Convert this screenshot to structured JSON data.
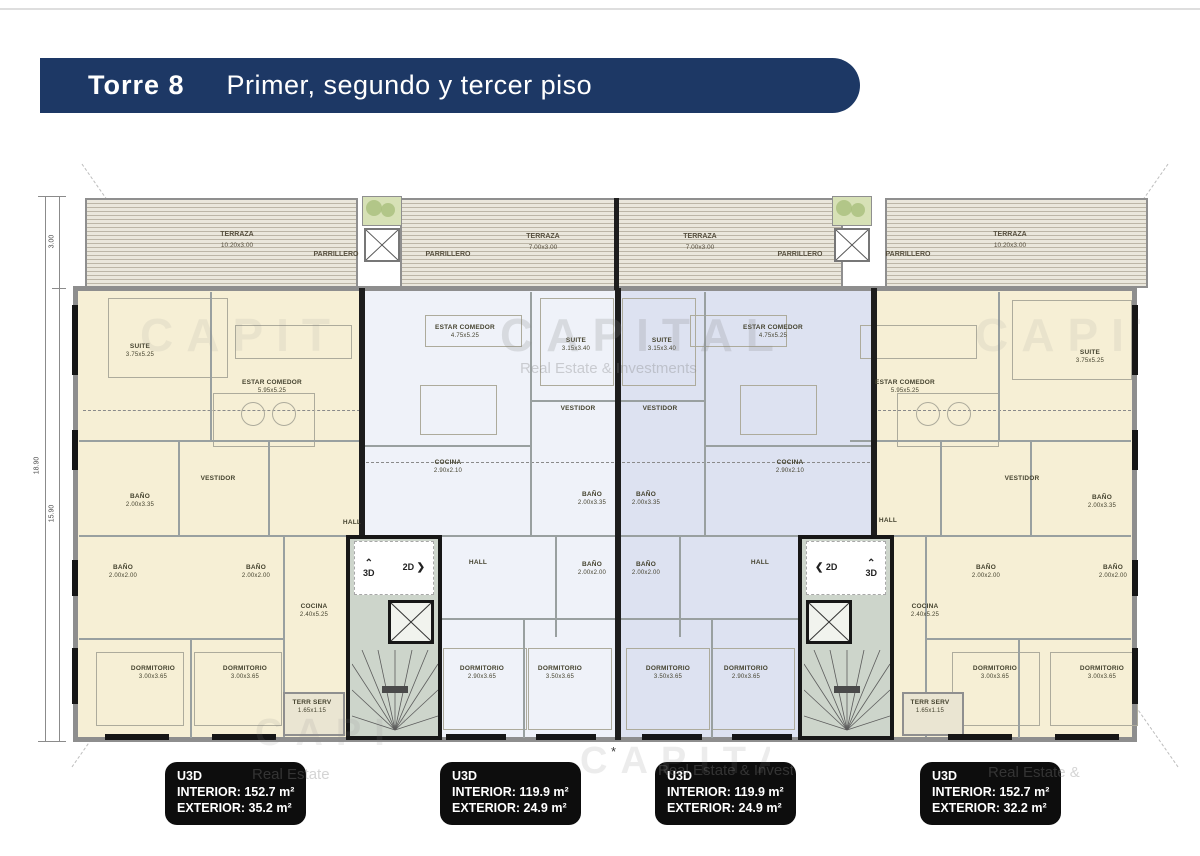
{
  "header": {
    "tower_label": "Torre  8",
    "floors_label": "Primer, segundo y tercer piso"
  },
  "watermark": {
    "brand": "CAPITAL",
    "tagline": "Real Estate & Investments"
  },
  "dims": {
    "total_height": "18.90",
    "inner_height": "15.90",
    "terrace_depth": "3.00"
  },
  "terrace": {
    "t1": {
      "name": "TERRAZA",
      "size": "10.20x3.00"
    },
    "t2": {
      "name": "TERRAZA",
      "size": "7.00x3.00"
    },
    "t3": {
      "name": "TERRAZA",
      "size": "7.00x3.00"
    },
    "t4": {
      "name": "TERRAZA",
      "size": "10.20x3.00"
    },
    "parrillero": "PARRILLERO"
  },
  "core": {
    "d3": "3D",
    "d2": "2D"
  },
  "icons": {
    "up": "⌃",
    "right": "❯",
    "left": "❮",
    "asterisk": "*"
  },
  "rooms": [
    {
      "label": "SUITE",
      "size": "3.75x5.25"
    },
    {
      "label": "ESTAR COMEDOR",
      "size": "5.95x5.25"
    },
    {
      "label": "VESTIDOR",
      "size": ""
    },
    {
      "label": "BAÑO",
      "size": "2.00x3.35"
    },
    {
      "label": "BAÑO",
      "size": "2.00x2.00"
    },
    {
      "label": "BAÑO",
      "size": "2.00x2.00"
    },
    {
      "label": "COCINA",
      "size": "2.40x5.25"
    },
    {
      "label": "HALL",
      "size": ""
    },
    {
      "label": "DORMITORIO",
      "size": "3.00x3.65"
    },
    {
      "label": "DORMITORIO",
      "size": "3.00x3.65"
    },
    {
      "label": "TERR SERV",
      "size": "1.65x1.15"
    },
    {
      "label": "ESTAR COMEDOR",
      "size": "4.75x5.25"
    },
    {
      "label": "SUITE",
      "size": "3.15x3.40"
    },
    {
      "label": "VESTIDOR",
      "size": ""
    },
    {
      "label": "COCINA",
      "size": "2.90x2.10"
    },
    {
      "label": "BAÑO",
      "size": "2.00x3.35"
    },
    {
      "label": "HALL",
      "size": ""
    },
    {
      "label": "BAÑO",
      "size": "2.00x2.00"
    },
    {
      "label": "DORMITORIO",
      "size": "2.90x3.65"
    },
    {
      "label": "DORMITORIO",
      "size": "3.50x3.65"
    },
    {
      "label": "SUITE",
      "size": "3.15x3.40"
    },
    {
      "label": "ESTAR COMEDOR",
      "size": "4.75x5.25"
    },
    {
      "label": "VESTIDOR",
      "size": ""
    },
    {
      "label": "COCINA",
      "size": "2.90x2.10"
    },
    {
      "label": "BAÑO",
      "size": "2.00x3.35"
    },
    {
      "label": "BAÑO",
      "size": "2.00x2.00"
    },
    {
      "label": "HALL",
      "size": ""
    },
    {
      "label": "DORMITORIO",
      "size": "3.50x3.65"
    },
    {
      "label": "DORMITORIO",
      "size": "2.90x3.65"
    },
    {
      "label": "ESTAR COMEDOR",
      "size": "5.95x5.25"
    },
    {
      "label": "SUITE",
      "size": "3.75x5.25"
    },
    {
      "label": "VESTIDOR",
      "size": ""
    },
    {
      "label": "BAÑO",
      "size": "2.00x3.35"
    },
    {
      "label": "HALL",
      "size": ""
    },
    {
      "label": "BAÑO",
      "size": "2.00x2.00"
    },
    {
      "label": "BAÑO",
      "size": "2.00x2.00"
    },
    {
      "label": "COCINA",
      "size": "2.40x5.25"
    },
    {
      "label": "DORMITORIO",
      "size": "3.00x3.65"
    },
    {
      "label": "DORMITORIO",
      "size": "3.00x3.65"
    },
    {
      "label": "TERR SERV",
      "size": "1.65x1.15"
    }
  ],
  "legend": [
    {
      "unit": "U3D",
      "interior": "INTERIOR: 152.7 m²",
      "exterior": "EXTERIOR: 35.2 m²"
    },
    {
      "unit": "U3D",
      "interior": "INTERIOR: 119.9 m²",
      "exterior": "EXTERIOR: 24.9 m²"
    },
    {
      "unit": "U3D",
      "interior": "INTERIOR: 119.9 m²",
      "exterior": "EXTERIOR: 24.9 m²"
    },
    {
      "unit": "U3D",
      "interior": "INTERIOR: 152.7 m²",
      "exterior": "EXTERIOR: 32.2 m²"
    }
  ]
}
